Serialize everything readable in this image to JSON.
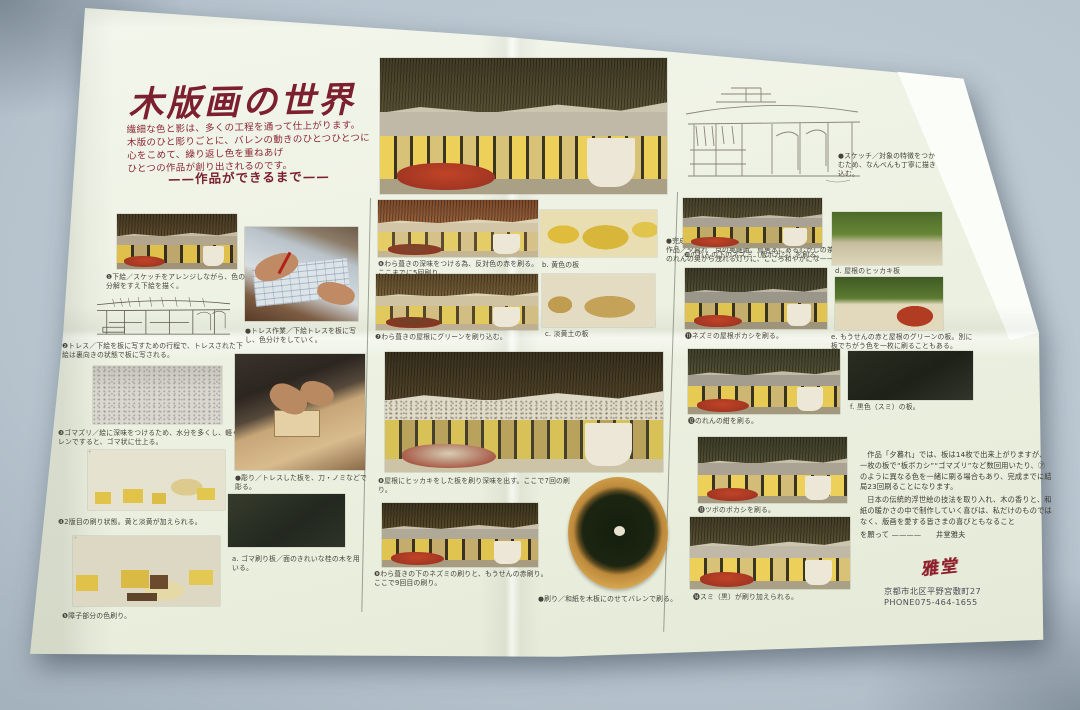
{
  "header": {
    "title": "木版画の世界",
    "intro": [
      "繊細な色と影は、多くの工程を通って仕上がります。",
      "木版のひと彫りごとに、バレンの動きのひとつひとつに",
      "心をこめて、繰り返し色を重ねあげ",
      "ひとつの作品が創り出されるのです。"
    ],
    "subtitle": "——作品ができるまで——"
  },
  "top": {
    "sketch_caption": "●スケッチ／対象の特徴をつかむため、なんべんも丁寧に描き込む。",
    "finish": [
      "●完成／これ迄23回刷られた。",
      "作品／夕暮れ　京の奥嵯峨、鳥居本にあるむかしの茶店。",
      "のれんの奥から洩れる灯りに、こころ和やかにな——"
    ]
  },
  "steps": [
    {
      "caption": "❶下絵／スケッチをアレンジしながら、色の分解をすえ下絵を描く。"
    },
    {
      "caption": "❷トレス／下絵を板に写すための行程で、トレスされた下絵は裏向きの状態で板に写される。"
    },
    {
      "caption": "❸ゴマズリ／絵に深味をつけるため、水分を多くし、軽くバレンですると、ゴマ状に仕上る。"
    },
    {
      "caption": "❹2版目の刷り状態。黄と淡黄が加えられる。"
    },
    {
      "caption": "❺障子部分の色刷り。"
    },
    {
      "caption": "❻わら葺きの深味をつける為、反対色の赤を刷る。ここまでに5回刷り。"
    },
    {
      "caption": "❼わら葺きの屋根にグリーンを刷り込む。"
    },
    {
      "caption": "❽屋根にヒッカキをした板を刷り深味を出す。ここで7回の刷り。"
    },
    {
      "caption": "❾わら葺きの下のネズミの刷りと、もうせんの赤刷り。ここで9回目の刷り。"
    },
    {
      "caption": "❿のれんの下のネズミ（版ボカシ）を刷る。"
    },
    {
      "caption": "⓫ネズミの屋根ボカシを刷る。"
    },
    {
      "caption": "⓬のれんの紺を刷る。"
    },
    {
      "caption": "⓭ツボのボカシを刷る。"
    },
    {
      "caption": "⓮スミ（黒）が刷り加えられる。"
    }
  ],
  "process_photos": [
    {
      "caption": "●トレス作業／下絵トレスを板に写し、色分けをしていく。"
    },
    {
      "caption": "●彫り／トレスした板を、刀・ノミなどで彫る。"
    },
    {
      "caption": "●刷り／和紙を木板にのせてバレンで刷る。"
    }
  ],
  "plates": [
    {
      "caption": "a. ゴマ刷り板／面のきれいな桂の木を用いる。"
    },
    {
      "caption": "b. 黄色の板"
    },
    {
      "caption": "c. 淡黄土の板"
    },
    {
      "caption": "d. 屋根のヒッカキ板"
    },
    {
      "caption": "e. もうせんの赤と屋根のグリーンの板。別に板でちがう色を一枚に刷ることもある。"
    },
    {
      "caption": "f. 黒色（スミ）の板。"
    }
  ],
  "essay": {
    "p1": "作品「夕暮れ」では、板は14枚で出来上がりますが、一枚の板で“板ボカシ”“ゴマズリ”など数回用いたり、㋐のように異なる色を一緒に刷る場合もあり、完成までに結局23回刷ることになります。",
    "p2": "日本の伝統的浮世絵の技法を取り入れ、木の香りと、和紙の暖かさの中で制作していく喜びは、私だけのものではなく、版画を愛する皆さまの喜びともなること",
    "signature_line": "を願って ————　　井堂雅夫"
  },
  "footer": {
    "stamp": "雅堂",
    "address": "京都市北区平野宮敷町27",
    "phone": "PHONE075-464-1655"
  },
  "colors": {
    "accent_red": "#7c1f2e",
    "paper": "#eef2e4",
    "table": "#b6c3cd"
  }
}
